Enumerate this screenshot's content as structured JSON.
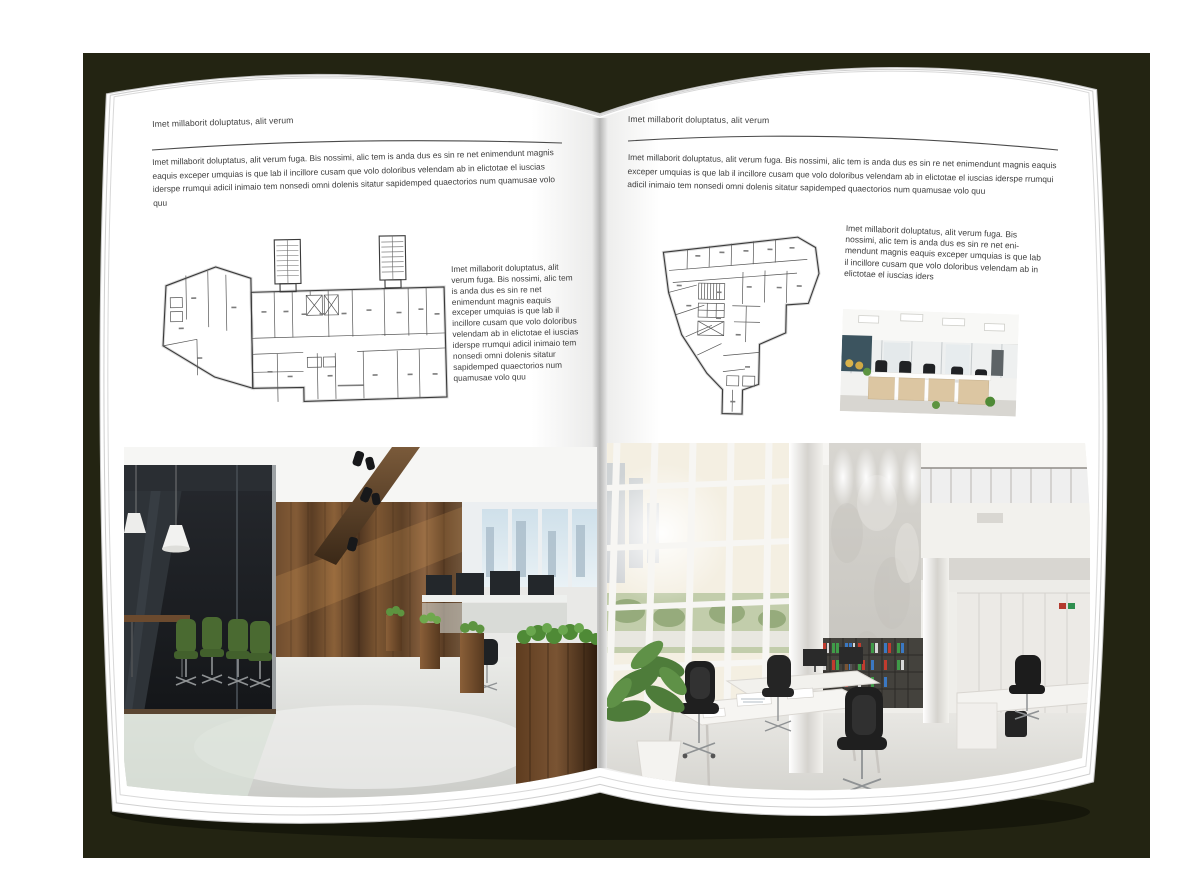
{
  "scene": {
    "backdrop_color": "#232412",
    "page_color": "#ffffff",
    "text_color": "#3e3e3e",
    "rule_color": "#4a4a4a"
  },
  "left_page": {
    "running_head": "Imet millaborit doluptatus, alit verum",
    "intro": "Imet millaborit doluptatus, alit verum fuga. Bis nossimi, alic tem is anda dus es sin re net enimendunt magnis eaquis exceper umquias is que lab il incillore cusam que volo doloribus velendam ab in elictotae el iuscias iderspe rrumqui adicil inimaio tem nonsedi omni dolenis sitatur sapidemped quaectorios num quamusae volo quu",
    "side_text": "Imet millaborit doluptatus, alit verum fuga. Bis nossimi, alic tem is anda dus es sin re net enimendunt magnis eaquis exceper umquias is que lab il incillore cusam que volo doloribus velendam ab in elictotae el iuscias iderspe rrumqui adicil inimaio tem nonsedi omni dolenis sitatur sapidemped quaectorios num quamusae volo quu"
  },
  "right_page": {
    "running_head": "Imet millaborit doluptatus, alit verum",
    "intro": "Imet millaborit doluptatus, alit verum fuga. Bis nossimi, alic tem is anda dus es sin re net enimendunt magnis eaquis exceper umquias is que lab il incillore cusam que volo doloribus velendam ab in elictotae el iuscias iderspe rrumqui adicil inimaio tem nonsedi omni dolenis sitatur sapidemped quaectorios num quamusae volo quu",
    "side_text": "Imet millaborit doluptatus, alit verum fuga. Bis nossimi, alic tem is anda dus es sin re net eni-mendunt magnis eaquis exceper umquias is que lab il incillore cusam que volo doloribus velendam ab in elictotae el iuscias iders"
  }
}
